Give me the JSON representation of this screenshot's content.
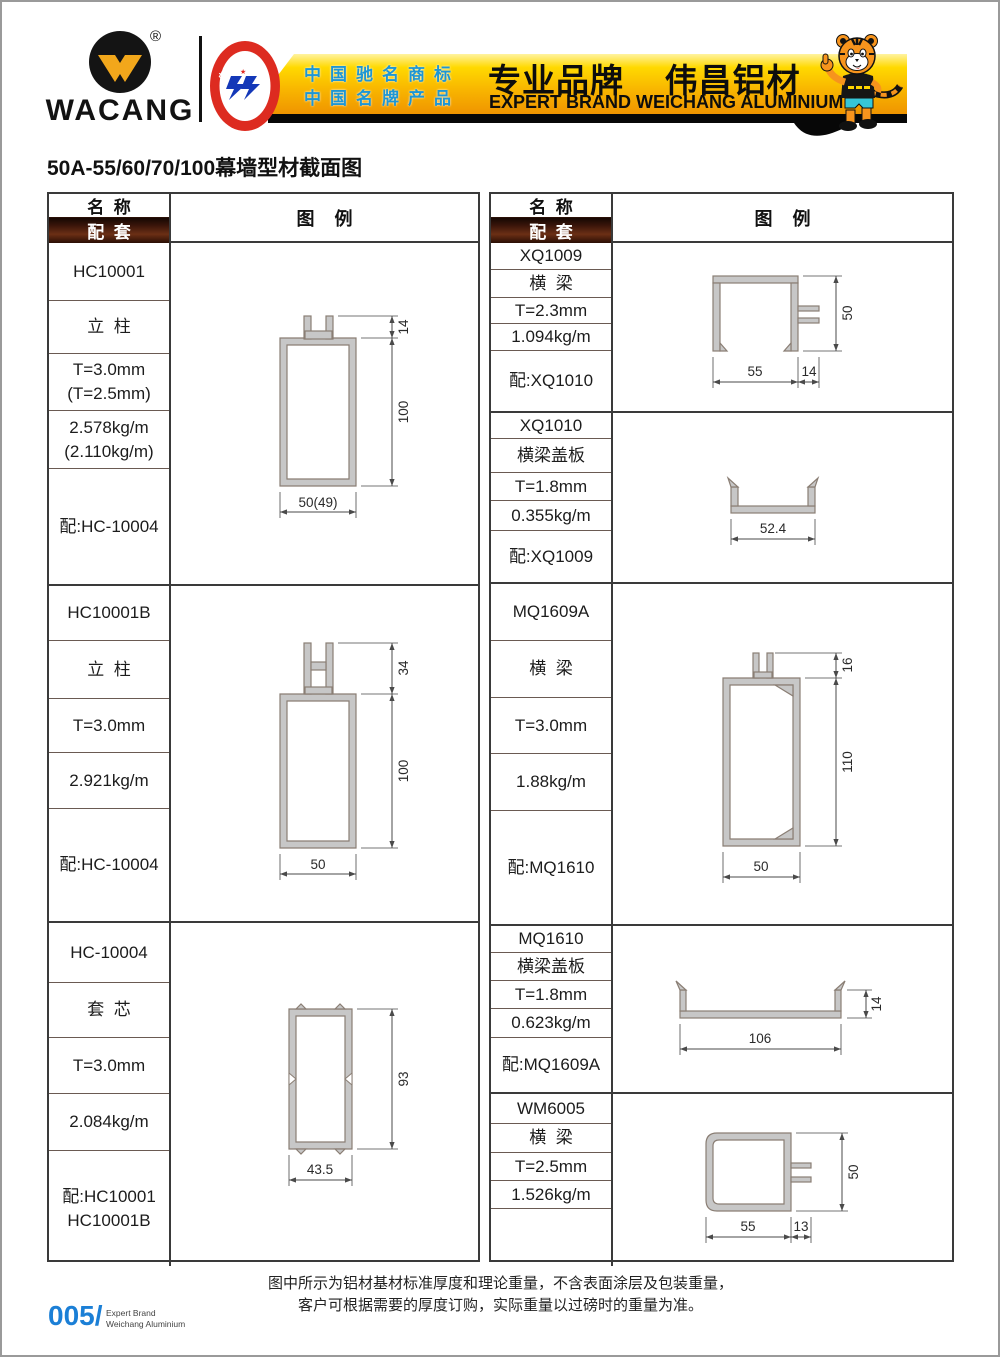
{
  "header": {
    "brand": "WACANG",
    "registered_mark": "®",
    "badge": {
      "top_text": "中国名牌",
      "bottom_text": "CHINA TOP BRAND"
    },
    "banner": {
      "tagline1": "中国驰名商标",
      "tagline2": "中国名牌产品",
      "title_cn": "专业品牌    伟昌铝材",
      "title_en": "EXPERT BRAND WEICHANG ALUMINIUM"
    }
  },
  "page_title": "50A-55/60/70/100幕墙型材截面图",
  "table_header": {
    "name": "名  称",
    "match": "配  套",
    "legend": "图    例"
  },
  "left_products": [
    {
      "id": "HC10001",
      "rows": [
        [
          "HC10001"
        ],
        [
          "立  柱"
        ],
        [
          "T=3.0mm",
          "(T=2.5mm)"
        ],
        [
          "2.578kg/m",
          "(2.110kg/m)"
        ],
        [
          "配:HC-10004"
        ]
      ],
      "dims": {
        "a": "14",
        "b": "100",
        "c": "50(49)"
      }
    },
    {
      "id": "HC10001B",
      "rows": [
        [
          "HC10001B"
        ],
        [
          "立  柱"
        ],
        [
          "T=3.0mm"
        ],
        [
          "2.921kg/m"
        ],
        [
          "配:HC-10004"
        ]
      ],
      "dims": {
        "a": "34",
        "b": "100",
        "c": "50"
      }
    },
    {
      "id": "HC-10004",
      "rows": [
        [
          "HC-10004"
        ],
        [
          "套  芯"
        ],
        [
          "T=3.0mm"
        ],
        [
          "2.084kg/m"
        ],
        [
          "配:HC10001",
          "HC10001B"
        ]
      ],
      "dims": {
        "b": "93",
        "c": "43.5"
      }
    }
  ],
  "right_products": [
    {
      "id": "XQ1009",
      "rows": [
        [
          "XQ1009"
        ],
        [
          "横  梁"
        ],
        [
          "T=2.3mm"
        ],
        [
          "1.094kg/m"
        ],
        [
          "配:XQ1010"
        ]
      ],
      "dims": {
        "b": "50",
        "c": "55",
        "d": "14"
      }
    },
    {
      "id": "XQ1010",
      "rows": [
        [
          "XQ1010"
        ],
        [
          "横梁盖板"
        ],
        [
          "T=1.8mm"
        ],
        [
          "0.355kg/m"
        ],
        [
          "配:XQ1009"
        ]
      ],
      "dims": {
        "c": "52.4"
      }
    },
    {
      "id": "MQ1609A",
      "rows": [
        [
          "MQ1609A"
        ],
        [
          "横  梁"
        ],
        [
          "T=3.0mm"
        ],
        [
          "1.88kg/m"
        ],
        [
          "配:MQ1610"
        ]
      ],
      "dims": {
        "a": "16",
        "b": "110",
        "c": "50"
      }
    },
    {
      "id": "MQ1610",
      "rows": [
        [
          "MQ1610"
        ],
        [
          "横梁盖板"
        ],
        [
          "T=1.8mm"
        ],
        [
          "0.623kg/m"
        ],
        [
          "配:MQ1609A"
        ]
      ],
      "dims": {
        "c": "106",
        "d": "14"
      }
    },
    {
      "id": "WM6005",
      "rows": [
        [
          "WM6005"
        ],
        [
          "横  梁"
        ],
        [
          "T=2.5mm"
        ],
        [
          "1.526kg/m"
        ],
        [
          ""
        ]
      ],
      "dims": {
        "b": "50",
        "c": "55",
        "d": "13"
      }
    }
  ],
  "footer": {
    "note1": "图中所示为铝材基材标准厚度和理论重量，不含表面涂层及包装重量，",
    "note2": "客户可根据需要的厚度订购，实际重量以过磅时的重量为准。",
    "page_number": "005/",
    "page_sub1": "Expert Brand",
    "page_sub2": "Weichang Aluminium"
  },
  "colors": {
    "banner_gold": "#ffd400",
    "accent_blue": "#1d96d4",
    "page_number_blue": "#1b7fd6",
    "match_bar_brown": "#3a150a",
    "profile_fill": "#c7c7c7"
  }
}
